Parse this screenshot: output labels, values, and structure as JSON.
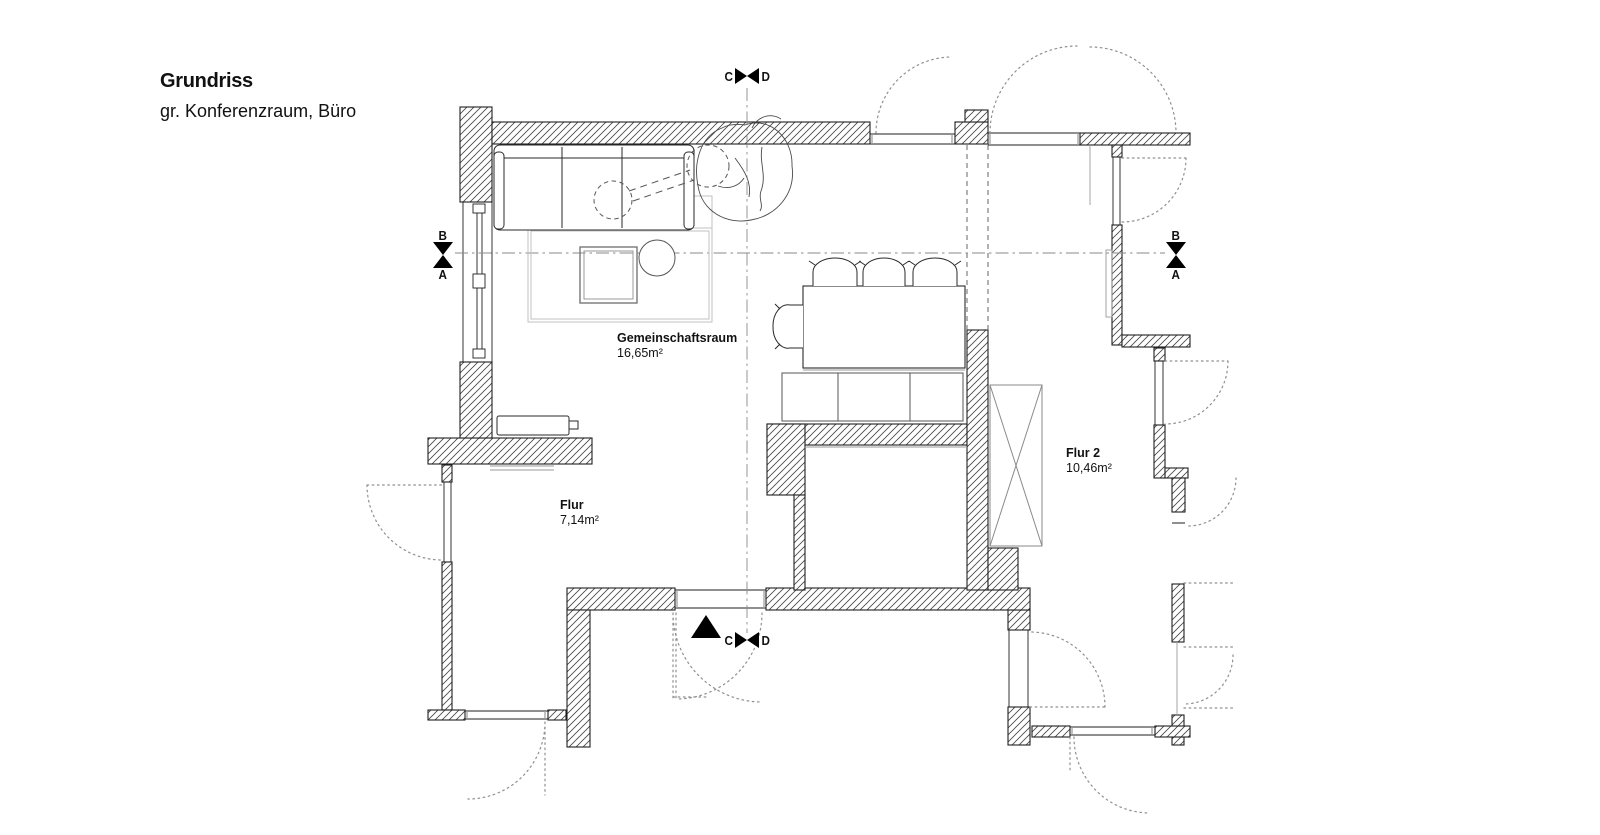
{
  "header": {
    "title": "Grundriss",
    "subtitle": "gr. Konferenzraum, Büro"
  },
  "rooms": [
    {
      "name": "Gemeinschaftsraum",
      "area": "16,65m²"
    },
    {
      "name": "Flur",
      "area": "7,14m²"
    },
    {
      "name": "Flur 2",
      "area": "10,46m²"
    }
  ],
  "section_markers": {
    "top": {
      "left_label": "C",
      "right_label": "D"
    },
    "bottom": {
      "left_label": "C",
      "right_label": "D"
    },
    "left": {
      "top_label": "B",
      "bottom_label": "A"
    },
    "right": {
      "top_label": "B",
      "bottom_label": "A"
    }
  },
  "colors": {
    "background": "#ffffff",
    "ink": "#1f1f1f",
    "hatch": "#444444",
    "light_gray": "#9a9a9a",
    "dotted": "#8f8f8f"
  }
}
